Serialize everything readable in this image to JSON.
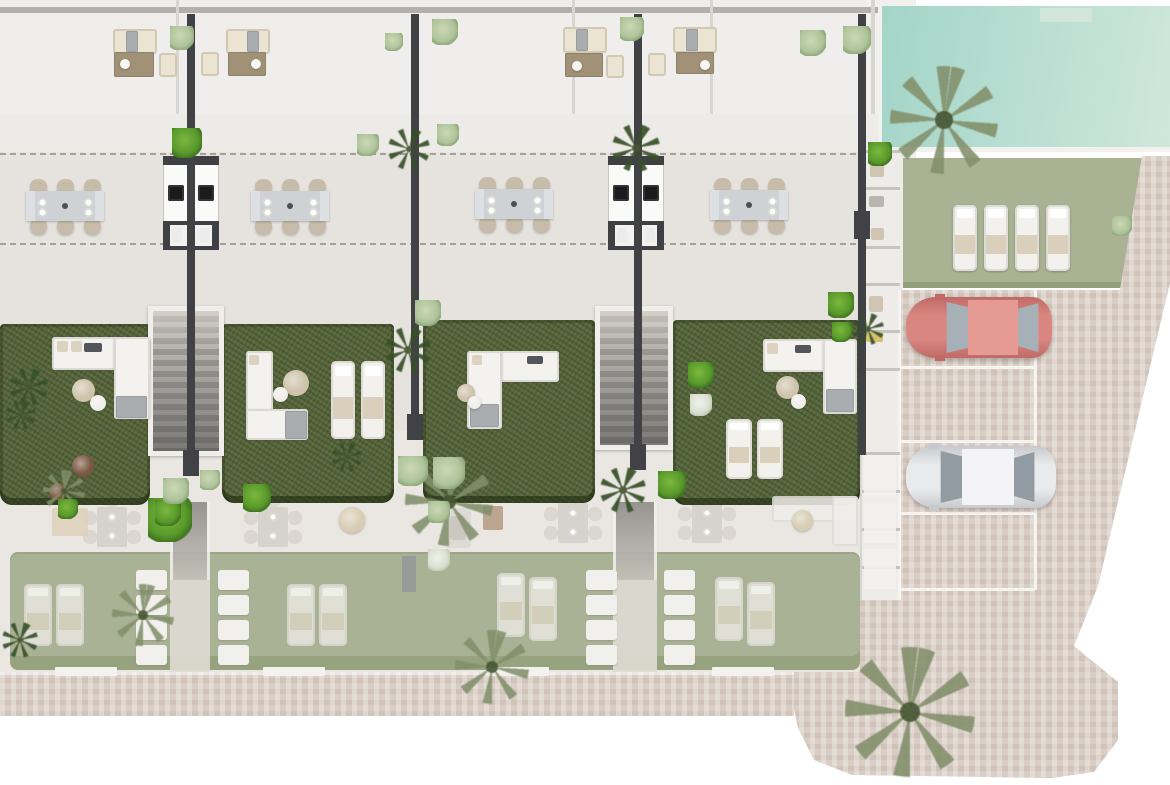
{
  "meta": {
    "title": "Residential development site plan — ground floor top view",
    "description": "Top-down architectural render: four townhouse units with roof terraces, outdoor kitchens, dining terraces, private gardens with lounge furniture, communal pool and lawn, parking with two cars, brick-paved driveway. Lower level shown ghosted.",
    "canvas": {
      "w": 1170,
      "h": 785
    }
  },
  "palette": {
    "terrace": "#e6e3de",
    "roof": "#f0eeec",
    "ghost_floor": "#eae7e2",
    "garden_green": "#57663c",
    "ghost_lawn": "#a9b295",
    "pool_teal": "#aedacf",
    "brick": "#d9cec5",
    "wall_dark": "#404246",
    "sofa_white": "#f3f2ef",
    "sofa_beige": "#ebe4d3",
    "pouf_beige": "#cec3ab",
    "pouf_white": "#efeeea",
    "pot_terracotta": "#7b5843",
    "car_red": "#dd8d87",
    "car_white": "#ecedef",
    "glass_gray": "#a7b0b6",
    "accent_yellow": "#d6c171",
    "decor_dark": "#54555a",
    "blanket_gray": "#a9adb0",
    "table_brown": "#a09177",
    "chair_beige": "#c7bcaa"
  },
  "scene": {
    "gardens": [
      {
        "x": 0,
        "y": 324,
        "w": 150,
        "h": 181
      },
      {
        "x": 222,
        "y": 324,
        "w": 172,
        "h": 179
      },
      {
        "x": 423,
        "y": 320,
        "w": 172,
        "h": 183
      },
      {
        "x": 673,
        "y": 320,
        "w": 187,
        "h": 185
      }
    ],
    "stairs": [
      {
        "x": 148,
        "y": 306,
        "w": 76,
        "h": 150
      },
      {
        "x": 595,
        "y": 306,
        "w": 78,
        "h": 144
      }
    ],
    "walls": [
      {
        "x": 187,
        "y": 14,
        "w": 8,
        "h": 446,
        "cap": [
          183,
          450,
          16,
          26
        ]
      },
      {
        "x": 411,
        "y": 14,
        "w": 8,
        "h": 408,
        "cap": [
          407,
          414,
          16,
          26
        ]
      },
      {
        "x": 634,
        "y": 14,
        "w": 8,
        "h": 438,
        "cap": [
          630,
          444,
          16,
          26
        ]
      },
      {
        "x": 858,
        "y": 14,
        "w": 8,
        "h": 441,
        "cap": [
          854,
          211,
          16,
          28
        ]
      }
    ],
    "kitchens": [
      {
        "x": 163
      },
      {
        "x": 608
      }
    ],
    "dining_sets": [
      {
        "cx": 65,
        "cy": 206
      },
      {
        "cx": 290,
        "cy": 206
      },
      {
        "cx": 514,
        "cy": 204
      },
      {
        "cx": 749,
        "cy": 205
      }
    ],
    "roof_rects": [
      {
        "n": "roof-sofa",
        "x": 113,
        "y": 29,
        "w": 44,
        "h": 25,
        "k": "bsofa"
      },
      {
        "n": "roof-throw",
        "x": 126,
        "y": 31,
        "w": 12,
        "h": 21,
        "k": "blanket"
      },
      {
        "n": "roof-coffee-table",
        "x": 114,
        "y": 52,
        "w": 40,
        "h": 25,
        "k": "table-br"
      },
      {
        "n": "roof-armchair",
        "x": 159,
        "y": 53,
        "w": 18,
        "h": 24,
        "k": "bsofa"
      },
      {
        "n": "roof-sofa",
        "x": 226,
        "y": 29,
        "w": 44,
        "h": 25,
        "k": "bsofa"
      },
      {
        "n": "roof-throw",
        "x": 247,
        "y": 31,
        "w": 12,
        "h": 21,
        "k": "blanket"
      },
      {
        "n": "roof-coffee-table",
        "x": 228,
        "y": 52,
        "w": 38,
        "h": 24,
        "k": "table-br"
      },
      {
        "n": "roof-armchair",
        "x": 201,
        "y": 52,
        "w": 18,
        "h": 24,
        "k": "bsofa"
      },
      {
        "n": "roof-sofa",
        "x": 563,
        "y": 27,
        "w": 44,
        "h": 26,
        "k": "bsofa"
      },
      {
        "n": "roof-throw",
        "x": 576,
        "y": 29,
        "w": 12,
        "h": 22,
        "k": "blanket"
      },
      {
        "n": "roof-coffee-table",
        "x": 565,
        "y": 53,
        "w": 38,
        "h": 24,
        "k": "table-br"
      },
      {
        "n": "roof-armchair",
        "x": 606,
        "y": 55,
        "w": 18,
        "h": 23,
        "k": "bsofa"
      },
      {
        "n": "roof-sofa",
        "x": 673,
        "y": 27,
        "w": 44,
        "h": 26,
        "k": "bsofa"
      },
      {
        "n": "roof-throw",
        "x": 686,
        "y": 29,
        "w": 12,
        "h": 22,
        "k": "blanket"
      },
      {
        "n": "roof-coffee-table",
        "x": 676,
        "y": 52,
        "w": 38,
        "h": 22,
        "k": "table-br"
      },
      {
        "n": "roof-armchair",
        "x": 648,
        "y": 53,
        "w": 18,
        "h": 23,
        "k": "bsofa"
      }
    ],
    "garden_sofa_parts": [
      {
        "n": "garden-sofa",
        "x": 52,
        "y": 337,
        "w": 98,
        "h": 33,
        "k": "sofa"
      },
      {
        "n": "garden-sofa",
        "x": 114,
        "y": 337,
        "w": 36,
        "h": 82,
        "k": "sofa"
      },
      {
        "n": "sofa-blanket",
        "x": 116,
        "y": 396,
        "w": 31,
        "h": 22,
        "k": "blanket"
      },
      {
        "n": "sofa-pillow",
        "x": 57,
        "y": 341,
        "w": 11,
        "h": 11,
        "k": "pillow",
        "c": "#dbd2bf"
      },
      {
        "n": "sofa-pillow",
        "x": 71,
        "y": 341,
        "w": 11,
        "h": 11,
        "k": "pillow",
        "c": "#dbd2bf"
      },
      {
        "n": "sofa-decor",
        "x": 84,
        "y": 343,
        "w": 18,
        "h": 9,
        "k": "pillow",
        "c": "#54555a"
      },
      {
        "n": "garden-sofa",
        "x": 246,
        "y": 351,
        "w": 27,
        "h": 88,
        "k": "sofa"
      },
      {
        "n": "garden-sofa",
        "x": 246,
        "y": 409,
        "w": 62,
        "h": 31,
        "k": "sofa"
      },
      {
        "n": "sofa-blanket",
        "x": 285,
        "y": 411,
        "w": 22,
        "h": 28,
        "k": "blanket"
      },
      {
        "n": "sofa-pillow",
        "x": 249,
        "y": 355,
        "w": 10,
        "h": 10,
        "k": "pillow",
        "c": "#dbd2bf"
      },
      {
        "n": "garden-sofa",
        "x": 467,
        "y": 351,
        "w": 92,
        "h": 31,
        "k": "sofa"
      },
      {
        "n": "garden-sofa",
        "x": 467,
        "y": 351,
        "w": 35,
        "h": 78,
        "k": "sofa"
      },
      {
        "n": "sofa-blanket",
        "x": 470,
        "y": 404,
        "w": 29,
        "h": 23,
        "k": "blanket"
      },
      {
        "n": "sofa-decor",
        "x": 527,
        "y": 356,
        "w": 16,
        "h": 8,
        "k": "pillow",
        "c": "#54555a"
      },
      {
        "n": "sofa-pillow",
        "x": 472,
        "y": 355,
        "w": 10,
        "h": 10,
        "k": "pillow",
        "c": "#dbd2bf"
      },
      {
        "n": "garden-sofa",
        "x": 763,
        "y": 339,
        "w": 94,
        "h": 33,
        "k": "sofa"
      },
      {
        "n": "garden-sofa",
        "x": 823,
        "y": 339,
        "w": 34,
        "h": 75,
        "k": "sofa"
      },
      {
        "n": "sofa-blanket",
        "x": 826,
        "y": 389,
        "w": 28,
        "h": 23,
        "k": "blanket"
      },
      {
        "n": "sofa-pillow",
        "x": 767,
        "y": 343,
        "w": 11,
        "h": 11,
        "k": "pillow",
        "c": "#dbd2bf"
      },
      {
        "n": "sofa-decor",
        "x": 795,
        "y": 345,
        "w": 16,
        "h": 8,
        "k": "pillow",
        "c": "#54555a"
      },
      {
        "n": "ghost-sofa",
        "x": 772,
        "y": 496,
        "w": 86,
        "h": 26,
        "k": "gsofa"
      },
      {
        "n": "ghost-sofa",
        "x": 832,
        "y": 496,
        "w": 26,
        "h": 50,
        "k": "gsofa"
      }
    ],
    "loungers": [
      {
        "x": 331,
        "y": 361,
        "w": 24,
        "h": 78
      },
      {
        "x": 361,
        "y": 361,
        "w": 24,
        "h": 78
      },
      {
        "x": 726,
        "y": 419,
        "w": 26,
        "h": 60
      },
      {
        "x": 757,
        "y": 419,
        "w": 26,
        "h": 60
      },
      {
        "x": 953,
        "y": 205,
        "w": 24,
        "h": 66
      },
      {
        "x": 984,
        "y": 205,
        "w": 24,
        "h": 66
      },
      {
        "x": 1015,
        "y": 205,
        "w": 24,
        "h": 66
      },
      {
        "x": 1046,
        "y": 205,
        "w": 24,
        "h": 66
      },
      {
        "x": 24,
        "y": 584,
        "w": 28,
        "h": 62,
        "g": 1
      },
      {
        "x": 56,
        "y": 584,
        "w": 28,
        "h": 62,
        "g": 1
      },
      {
        "x": 287,
        "y": 584,
        "w": 28,
        "h": 62,
        "g": 1
      },
      {
        "x": 319,
        "y": 584,
        "w": 28,
        "h": 62,
        "g": 1
      },
      {
        "x": 497,
        "y": 573,
        "w": 28,
        "h": 64,
        "g": 1
      },
      {
        "x": 529,
        "y": 577,
        "w": 28,
        "h": 64,
        "g": 1
      },
      {
        "x": 715,
        "y": 577,
        "w": 28,
        "h": 64,
        "g": 1
      },
      {
        "x": 747,
        "y": 582,
        "w": 28,
        "h": 64,
        "g": 1
      }
    ],
    "circles": [
      {
        "n": "pouf-beige",
        "x": 72,
        "y": 379,
        "d": 23,
        "c": "#cec3ab"
      },
      {
        "n": "pouf-white",
        "x": 90,
        "y": 395,
        "d": 16,
        "c": "#efeeea"
      },
      {
        "n": "pouf-beige",
        "x": 283,
        "y": 370,
        "d": 26,
        "c": "#cec3ab"
      },
      {
        "n": "pouf-white",
        "x": 273,
        "y": 387,
        "d": 15,
        "c": "#efeeea"
      },
      {
        "n": "pouf-beige",
        "x": 457,
        "y": 384,
        "d": 18,
        "c": "#cec3ab"
      },
      {
        "n": "pouf-white",
        "x": 468,
        "y": 396,
        "d": 13,
        "c": "#efeeea"
      },
      {
        "n": "pouf-beige",
        "x": 776,
        "y": 376,
        "d": 23,
        "c": "#cec3ab"
      },
      {
        "n": "pouf-white",
        "x": 791,
        "y": 394,
        "d": 15,
        "c": "#efeeea"
      },
      {
        "n": "plant-pot",
        "x": 72,
        "y": 455,
        "d": 22,
        "c": "#7b5843"
      },
      {
        "n": "plant-pot",
        "x": 49,
        "y": 483,
        "d": 17,
        "c": "#7b5843"
      },
      {
        "n": "roof-plate",
        "x": 120,
        "y": 59,
        "d": 10,
        "c": "#f6f5f2"
      },
      {
        "n": "roof-plate",
        "x": 251,
        "y": 59,
        "d": 10,
        "c": "#f6f5f2"
      },
      {
        "n": "roof-plate",
        "x": 572,
        "y": 61,
        "d": 10,
        "c": "#f6f5f2"
      },
      {
        "n": "roof-plate",
        "x": 700,
        "y": 60,
        "d": 10,
        "c": "#f6f5f2"
      },
      {
        "n": "ghost-pouf",
        "x": 339,
        "y": 507,
        "d": 26,
        "c": "#d8cdb4"
      },
      {
        "n": "ghost-pouf",
        "x": 792,
        "y": 510,
        "d": 21,
        "c": "#d8cdb4"
      },
      {
        "n": "pool-steps",
        "x": 1040,
        "y": 8,
        "d": 0,
        "c": "#d3e6db",
        "w": 52,
        "h": 14
      }
    ],
    "square_tables": [
      {
        "cx": 112,
        "cy": 527
      },
      {
        "cx": 273,
        "cy": 527
      },
      {
        "cx": 573,
        "cy": 523
      },
      {
        "cx": 707,
        "cy": 523
      }
    ],
    "ghost_rects": [
      {
        "n": "ghost-armchair",
        "x": 445,
        "y": 508,
        "w": 26,
        "h": 40,
        "c": "#dcd9d3",
        "r": 4
      },
      {
        "n": "ghost-armchair-seat",
        "x": 450,
        "y": 516,
        "w": 16,
        "h": 24,
        "c": "#c9c5bf",
        "r": 3
      },
      {
        "n": "ghost-side-table",
        "x": 483,
        "y": 506,
        "w": 20,
        "h": 24,
        "c": "#b79f8a",
        "r": 2
      },
      {
        "n": "ghost-mat",
        "x": 52,
        "y": 508,
        "w": 36,
        "h": 28,
        "c": "#ddd2bd",
        "r": 2
      },
      {
        "n": "ghost-wall",
        "x": 402,
        "y": 556,
        "w": 14,
        "h": 36,
        "c": "#97979a",
        "r": 0
      },
      {
        "n": "ghost-box",
        "x": 864,
        "y": 455,
        "w": 32,
        "h": 42,
        "c": "#f3f2ef",
        "r": 2
      },
      {
        "n": "ghost-box",
        "x": 864,
        "y": 503,
        "w": 32,
        "h": 40,
        "c": "#f3f2ef",
        "r": 2
      },
      {
        "n": "ghost-box",
        "x": 864,
        "y": 549,
        "w": 32,
        "h": 40,
        "c": "#f3f2ef",
        "r": 2
      }
    ],
    "step_stacks": [
      {
        "x": 136
      },
      {
        "x": 218
      },
      {
        "x": 586
      },
      {
        "x": 664
      }
    ],
    "corridors": [
      {
        "x": 170,
        "w": 40
      },
      {
        "x": 613,
        "w": 44
      }
    ],
    "thresholds": [
      {
        "x": 55
      },
      {
        "x": 263
      },
      {
        "x": 487
      },
      {
        "x": 712
      }
    ],
    "parking_lines": [
      {
        "x": 898,
        "y": 290,
        "w": 3,
        "h": 310
      },
      {
        "x": 1034,
        "y": 290,
        "w": 3,
        "h": 300
      },
      {
        "x": 901,
        "y": 366,
        "w": 133,
        "h": 3
      },
      {
        "x": 901,
        "y": 440,
        "w": 133,
        "h": 3
      },
      {
        "x": 901,
        "y": 512,
        "w": 133,
        "h": 3
      },
      {
        "x": 901,
        "y": 588,
        "w": 133,
        "h": 3
      }
    ],
    "strip_dividers": [
      150,
      187,
      246,
      283,
      330,
      368,
      452,
      490,
      528,
      566
    ],
    "strip_items": [
      {
        "x": 870,
        "y": 160,
        "w": 14,
        "h": 17,
        "c": "#cfc5b2"
      },
      {
        "x": 869,
        "y": 196,
        "w": 15,
        "h": 11,
        "c": "#b9b6b1"
      },
      {
        "x": 871,
        "y": 228,
        "w": 13,
        "h": 12,
        "c": "#cfc5b2"
      },
      {
        "x": 869,
        "y": 296,
        "w": 14,
        "h": 16,
        "c": "#cfc5b2"
      },
      {
        "x": 866,
        "y": 332,
        "w": 17,
        "h": 10,
        "c": "#d6c171"
      }
    ],
    "cars": [
      {
        "n": "red-car",
        "x": 906,
        "y": 297,
        "w": 146,
        "h": 61,
        "body": "#d98680",
        "edge": "#c06a65",
        "roof": "#e59a93",
        "glass": "#a7b0b6",
        "ws": [
          36,
          26
        ],
        "roof_r": [
          62,
          50
        ],
        "rear": [
          112,
          24
        ]
      },
      {
        "n": "white-car",
        "x": 906,
        "y": 446,
        "w": 150,
        "h": 62,
        "body": "#e9eaec",
        "edge": "#c7c9cd",
        "roof": "#f4f4f6",
        "glass": "#929aa2",
        "ws": [
          30,
          26
        ],
        "roof_r": [
          56,
          52
        ],
        "rear": [
          108,
          24
        ]
      }
    ],
    "plants": [
      {
        "x": 890,
        "y": 66,
        "d": 108,
        "t": "o"
      },
      {
        "x": 845,
        "y": 647,
        "d": 130,
        "t": "o"
      },
      {
        "x": 405,
        "y": 458,
        "d": 88,
        "t": "o"
      },
      {
        "x": 112,
        "y": 584,
        "d": 62,
        "t": "o"
      },
      {
        "x": 455,
        "y": 630,
        "d": 74,
        "t": "o"
      },
      {
        "x": 43,
        "y": 470,
        "d": 42,
        "t": "o"
      },
      {
        "x": 388,
        "y": 128,
        "d": 42,
        "t": "k"
      },
      {
        "x": 612,
        "y": 124,
        "d": 48,
        "t": "k"
      },
      {
        "x": 10,
        "y": 368,
        "d": 38,
        "t": "k"
      },
      {
        "x": 6,
        "y": 400,
        "d": 30,
        "t": "k"
      },
      {
        "x": 600,
        "y": 467,
        "d": 46,
        "t": "k"
      },
      {
        "x": 385,
        "y": 327,
        "d": 46,
        "t": "k"
      },
      {
        "x": 332,
        "y": 442,
        "d": 30,
        "t": "k"
      },
      {
        "x": 852,
        "y": 313,
        "d": 32,
        "t": "k"
      },
      {
        "x": 2,
        "y": 622,
        "d": 36,
        "t": "k"
      },
      {
        "x": 172,
        "y": 128,
        "d": 30,
        "t": "b"
      },
      {
        "x": 828,
        "y": 292,
        "d": 26,
        "t": "b"
      },
      {
        "x": 688,
        "y": 362,
        "d": 26,
        "t": "b"
      },
      {
        "x": 658,
        "y": 471,
        "d": 28,
        "t": "b"
      },
      {
        "x": 148,
        "y": 498,
        "d": 44,
        "t": "b"
      },
      {
        "x": 243,
        "y": 484,
        "d": 28,
        "t": "b"
      },
      {
        "x": 58,
        "y": 499,
        "d": 20,
        "t": "b"
      },
      {
        "x": 155,
        "y": 500,
        "d": 26,
        "t": "b"
      },
      {
        "x": 868,
        "y": 142,
        "d": 24,
        "t": "b"
      },
      {
        "x": 832,
        "y": 322,
        "d": 20,
        "t": "b"
      },
      {
        "x": 170,
        "y": 26,
        "d": 24,
        "t": "p"
      },
      {
        "x": 385,
        "y": 33,
        "d": 18,
        "t": "p"
      },
      {
        "x": 432,
        "y": 19,
        "d": 26,
        "t": "p"
      },
      {
        "x": 620,
        "y": 17,
        "d": 24,
        "t": "p"
      },
      {
        "x": 800,
        "y": 30,
        "d": 26,
        "t": "p"
      },
      {
        "x": 843,
        "y": 26,
        "d": 28,
        "t": "p"
      },
      {
        "x": 357,
        "y": 134,
        "d": 22,
        "t": "p"
      },
      {
        "x": 437,
        "y": 124,
        "d": 22,
        "t": "p"
      },
      {
        "x": 1112,
        "y": 216,
        "d": 20,
        "t": "p"
      },
      {
        "x": 398,
        "y": 456,
        "d": 30,
        "t": "p"
      },
      {
        "x": 433,
        "y": 457,
        "d": 32,
        "t": "p"
      },
      {
        "x": 428,
        "y": 501,
        "d": 22,
        "t": "p"
      },
      {
        "x": 163,
        "y": 478,
        "d": 26,
        "t": "p"
      },
      {
        "x": 200,
        "y": 470,
        "d": 20,
        "t": "p"
      },
      {
        "x": 415,
        "y": 300,
        "d": 26,
        "t": "p"
      },
      {
        "x": 690,
        "y": 394,
        "d": 22,
        "t": "w"
      },
      {
        "x": 428,
        "y": 549,
        "d": 22,
        "t": "w"
      }
    ]
  }
}
